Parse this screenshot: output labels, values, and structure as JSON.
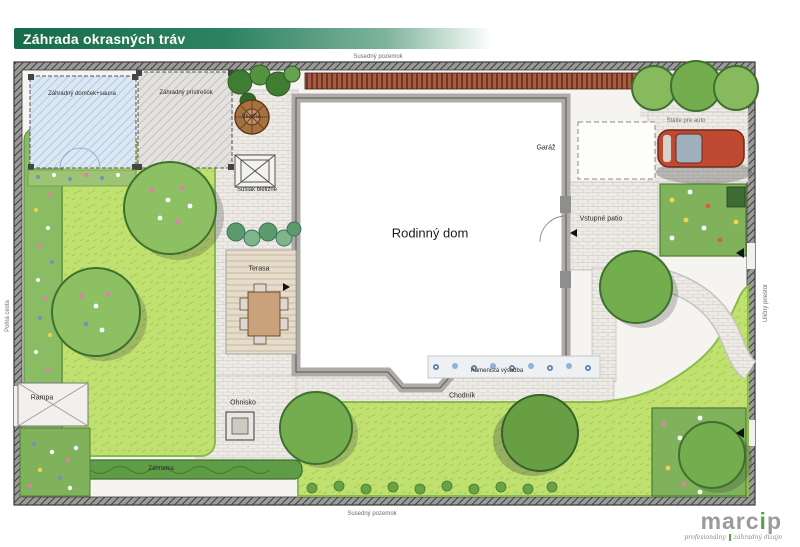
{
  "header": {
    "title": "Záhrada okrasných tráv"
  },
  "plan": {
    "surroundings": {
      "top": "Susedný pozemok",
      "bottom": "Susedný pozemok",
      "left": "Poľná cesta",
      "right": "Uličný priestor"
    },
    "labels": {
      "garden_house": "Záhradný domček+sauna",
      "shelter": "Záhradný prístrešok",
      "well": "Studňa",
      "clothes_dryer": "Sušiak bielizne",
      "family_house": "Rodinný dom",
      "garage": "Garáž",
      "entry_patio": "Vstupné patio",
      "car_parking": "Státie pre auto",
      "terrace": "Terasa",
      "stone_planting": "Kamenistá výsadba",
      "walkway": "Chodník",
      "fire_pit": "Ohnisko",
      "ramp": "Rampa",
      "garden_bed": "Záhradka"
    }
  },
  "logo": {
    "part1": "marc",
    "part2": "i",
    "part3": "p",
    "tagline_left": "profesionálny",
    "tagline_right": "záhradný dizajn"
  },
  "colors": {
    "banner_green": "#166b4a",
    "logo_green": "#57a548",
    "lawn_green": "#bfdf6e",
    "tree_green": "#74ad4d"
  }
}
